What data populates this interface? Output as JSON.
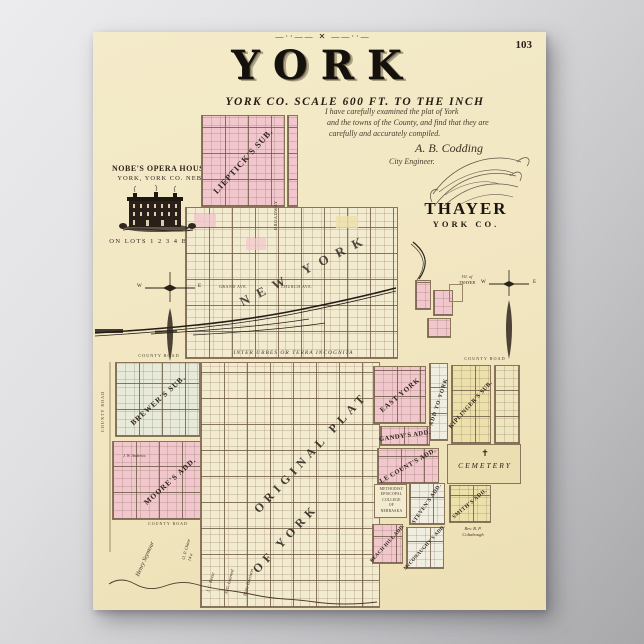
{
  "page": {
    "number": "103"
  },
  "header": {
    "ornament": "—··—— ✕ ——··—",
    "title": "YORK",
    "subtitle": "YORK CO.  SCALE 600 FT. TO THE INCH"
  },
  "certification": {
    "line1": "I have carefully examined the plat of York",
    "line2": "and the towns of the County, and find that they are",
    "line3": "carefully and accurately compiled.",
    "signature": "A. B. Codding",
    "role": "City Engineer."
  },
  "opera_house": {
    "name": "NOBE'S OPERA HOUSE",
    "location": "YORK, YORK CO. NEB.",
    "caption": "ON LOTS 1 2 3 4 BLK 68"
  },
  "thayer": {
    "title": "THAYER",
    "subtitle": "YORK CO.",
    "village_note": "Vil. of\nTHAYER"
  },
  "upper_plat": {
    "lieptick": "LIEPTICK'S SUB.",
    "new_york": "NEW YORK",
    "broadway": "BROADWAY",
    "grand_ave": "GRAND AVE.",
    "church_ave": "CHURCH AVE.",
    "inter_urbes": "INTER URBES OR TERRA INCOGNITA"
  },
  "compass": {
    "west": "W",
    "east": "E"
  },
  "lower_plat": {
    "county_road": "COUNTY ROAD",
    "brewers": "BREWER'S SUB.",
    "moores": "MOORE'S ADD.",
    "andrews": "J. W. Andrews",
    "original_1": "ORIGINAL PLAT",
    "original_2": "OF YORK",
    "east_york": "EAST YORK",
    "add_to_york": "ADD TO YORK",
    "kiplingers": "KIPLINGER'S SUB.",
    "gandys": "GANDY'S ADD.",
    "lecounts": "LE COUNT'S ADD.",
    "cemetery": "CEMETERY",
    "cemetery_cross": "✝",
    "college": "METHODIST\nEPISCOPAL\nCOLLEGE\nOF\nNEBRASKA",
    "stevens": "STEVEN'S ADD.",
    "smiths": "SMITH'S ADD.",
    "beach_hill": "BEACH HILL ADD.",
    "mcconaughy": "McCONAUGHY'S ADD.",
    "coltabough": "Rev. B. P.\nColtabough",
    "seymour": "Henry Seymour",
    "chase": "O. P. Chase\n14 a",
    "keese": "J. C. Keese",
    "learned": "A. G. Learned",
    "harrison": "Blake Harrison"
  },
  "colors": {
    "pink": "#f1c6cd",
    "yellow": "#ece0ab",
    "green": "#e7ead8",
    "cream": "#f3ebcf",
    "ink": "#3a2f26",
    "paper": "#f2e8c6"
  }
}
